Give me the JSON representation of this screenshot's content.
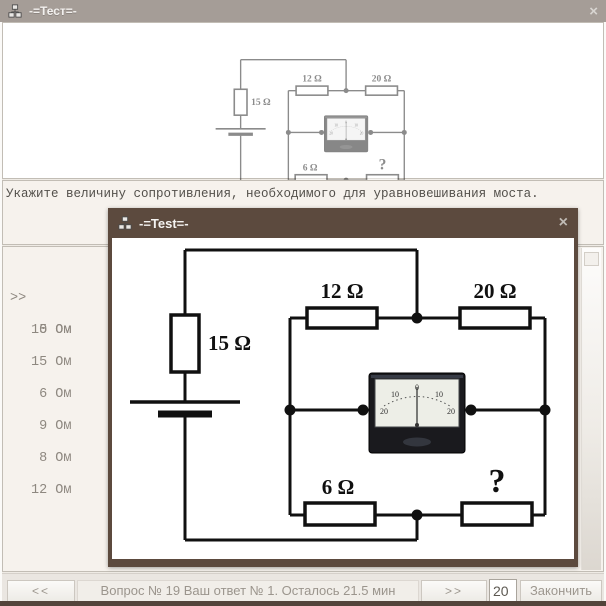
{
  "main_window": {
    "title": "-=Тест=-",
    "close": "×"
  },
  "popup_window": {
    "title": "-=Test=-",
    "close": "×"
  },
  "question_text": "Укажите величину сопротивления, необходимого для уравновешивания моста.",
  "answers": {
    "selected_marker": ">>",
    "items": [
      "10 Ом",
      " 5 Ом",
      "15 Ом",
      " 6 Ом",
      " 9 Ом",
      " 8 Ом",
      "12 Ом"
    ]
  },
  "circuit": {
    "resistor_left": "15 Ω",
    "resistor_top_left": "12 Ω",
    "resistor_top_right": "20 Ω",
    "resistor_bottom_left": "6 Ω",
    "resistor_bottom_right": "?",
    "meter_scale": [
      "20",
      "10",
      "0",
      "10",
      "20"
    ]
  },
  "bottom_bar": {
    "prev": "<<",
    "status": "Вопрос № 19 Ваш ответ № 1. Осталось 21.5 мин",
    "next": ">>",
    "page_value": "20",
    "finish": "Закончить"
  },
  "colors": {
    "main_titlebar": "#a59d97",
    "popup_frame": "#5c4a3e",
    "panel_bg": "#f6f2ed",
    "bottom_edge": "#53443b"
  }
}
